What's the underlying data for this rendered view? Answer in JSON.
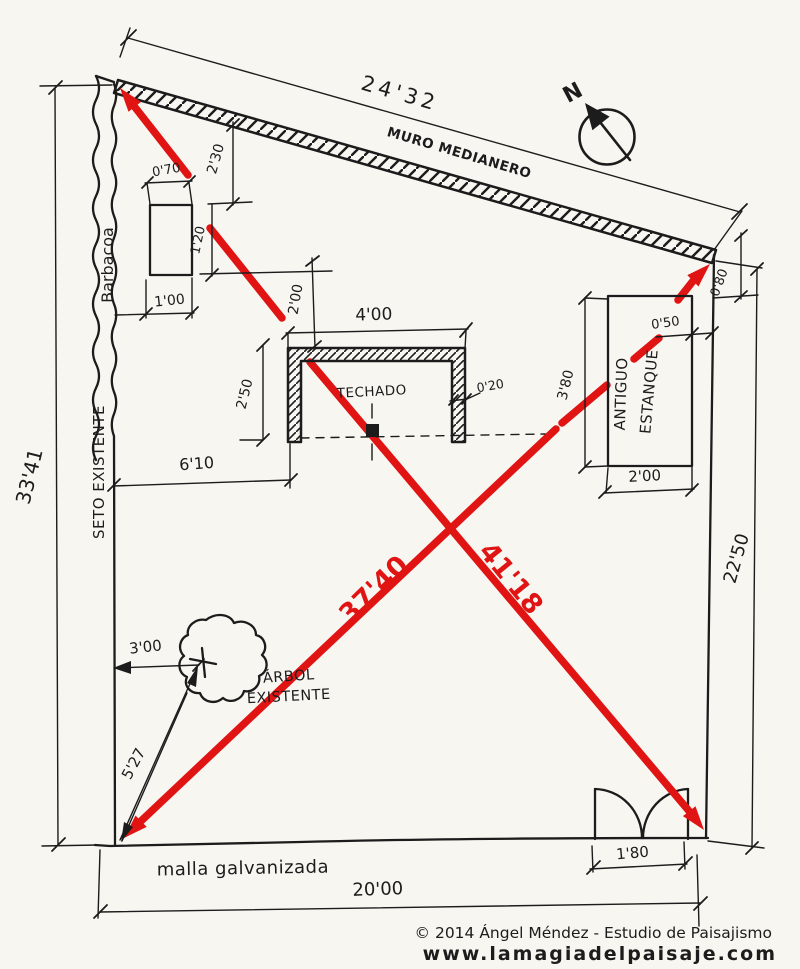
{
  "colors": {
    "paper": "#f8f6f1",
    "ink": "#1c1c1c",
    "red": "#e11414",
    "footer_gray": "#8a8a8a",
    "footer_dark": "#4d4d4d"
  },
  "compass": {
    "north_label": "N"
  },
  "boundaries": {
    "party_wall": {
      "label": "MURO MEDIANERO",
      "length_dim": "24'32",
      "end_offset_dim": "0'80"
    },
    "hedge": {
      "label": "SETO EXISTENTE",
      "length_dim": "33'41"
    },
    "right_side": {
      "length_dim": "22'50"
    },
    "fence": {
      "label": "malla galvanizada",
      "length_dim": "20'00"
    },
    "gate": {
      "width_dim": "1'80"
    }
  },
  "diagonals": {
    "sw_ne_dim": "37'40",
    "nw_se_dim": "41'18"
  },
  "barbecue": {
    "label": "Barbacoa",
    "width_dim": "1'00",
    "top_gap_dim": "0'70",
    "wall_gap_dim": "2'30",
    "side_gap_dim": "1'20"
  },
  "roofed_area": {
    "label": "TECHADO",
    "width_dim": "4'00",
    "wall_gap_dim": "2'00",
    "depth_dim": "2'50",
    "wall_thickness_dim": "0'20",
    "hedge_gap_dim": "6'10"
  },
  "pond": {
    "label_line1": "ANTIGUO",
    "label_line2": "ESTANQUE",
    "length_dim": "3'80",
    "boundary_gap_dim": "0'50",
    "width_dim": "2'00"
  },
  "tree": {
    "label_line1": "ÁRBOL",
    "label_line2": "EXISTENTE",
    "hedge_gap_dim": "3'00",
    "corner_dim": "5'27"
  },
  "footer": {
    "copyright": "© 2014 Ángel Méndez - Estudio de Paisajismo",
    "website": "www.lamagiadelpaisaje.com"
  }
}
